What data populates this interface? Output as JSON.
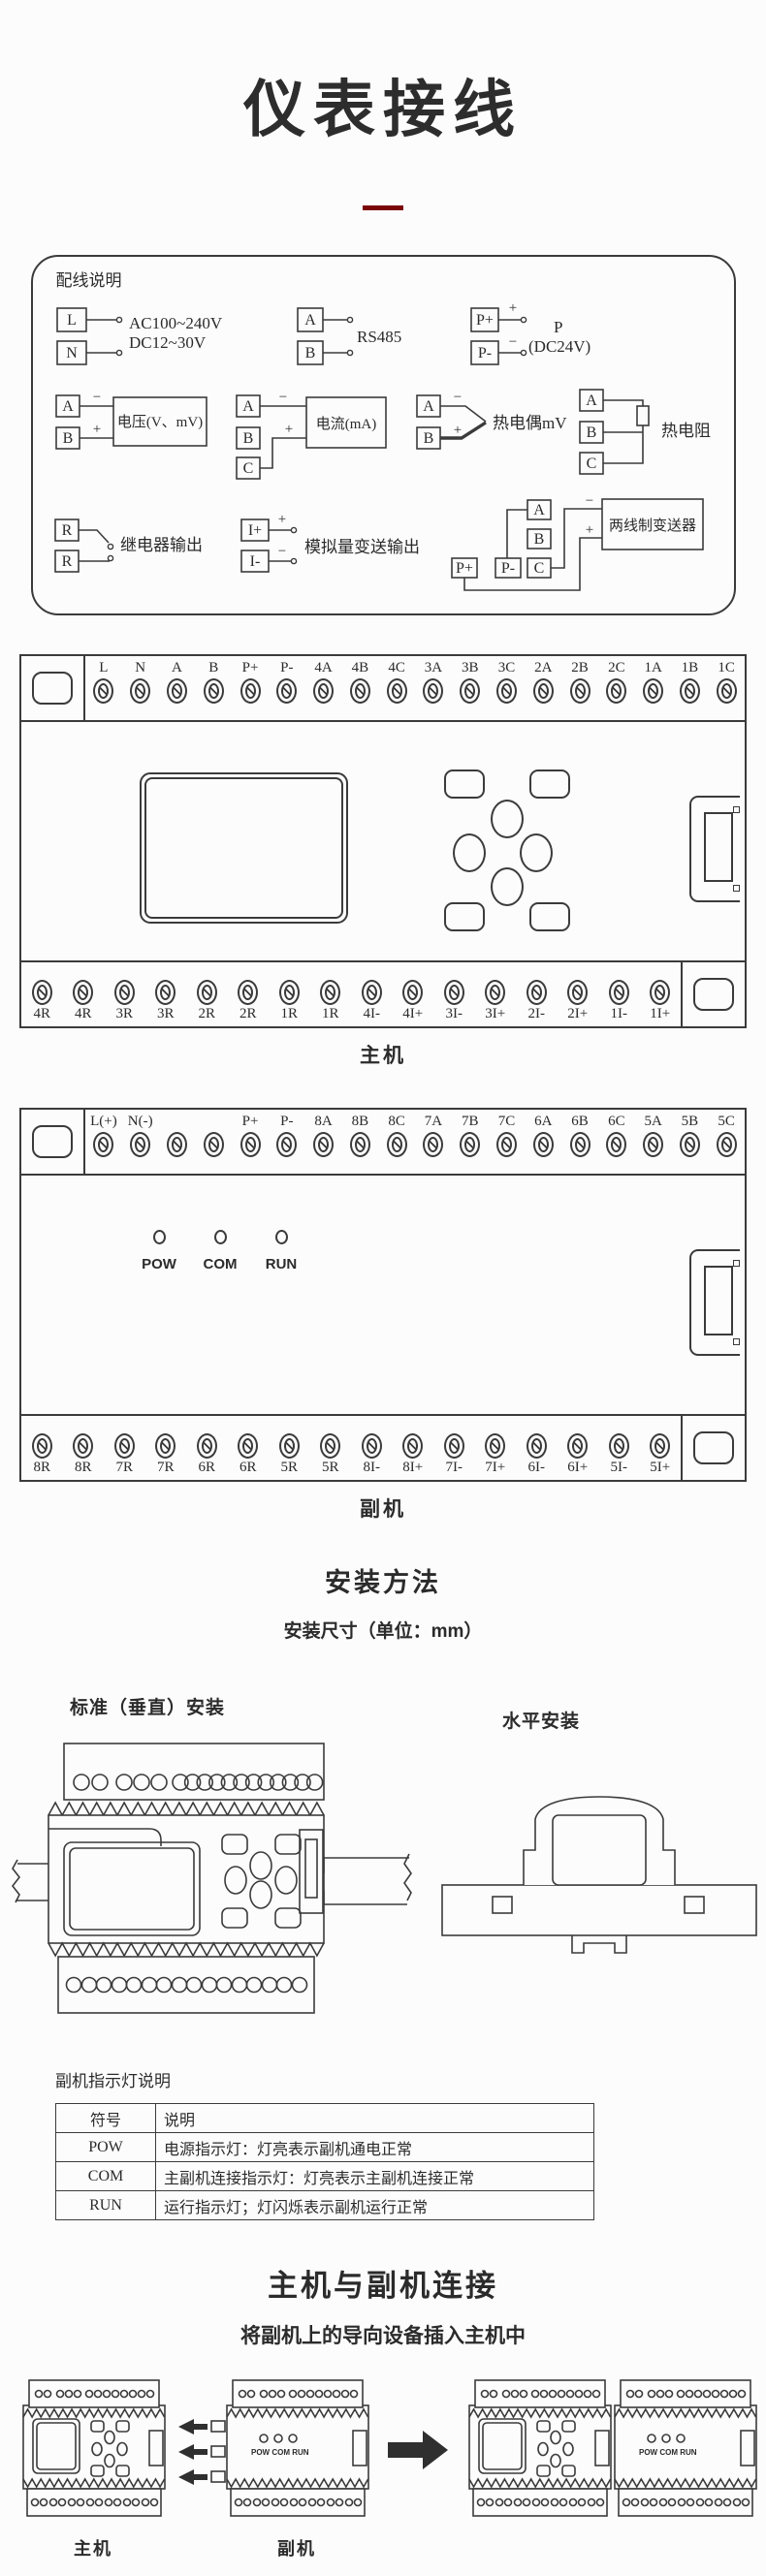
{
  "page": {
    "title": "仪表接线"
  },
  "wiring": {
    "box_title": "配线说明",
    "power": {
      "l": "L",
      "n": "N",
      "ac": "AC100~240V",
      "dc": "DC12~30V"
    },
    "rs485": {
      "a": "A",
      "b": "B",
      "label": "RS485"
    },
    "power24": {
      "pp": "P+",
      "pm": "P-",
      "plus": "+",
      "minus": "−",
      "p": "P",
      "dc": "(DC24V)"
    },
    "voltage": {
      "a": "A",
      "b": "B",
      "plus": "+",
      "minus": "−",
      "label": "电压(V、mV)"
    },
    "current": {
      "a": "A",
      "b": "B",
      "c": "C",
      "plus": "+",
      "minus": "−",
      "label": "电流(mA)"
    },
    "tc": {
      "a": "A",
      "b": "B",
      "plus": "+",
      "minus": "−",
      "label": "热电偶mV"
    },
    "rtd": {
      "a": "A",
      "b": "B",
      "c": "C",
      "label": "热电阻"
    },
    "relay": {
      "r1": "R",
      "r2": "R",
      "label": "继电器输出"
    },
    "analog": {
      "ip": "I+",
      "im": "I-",
      "plus": "+",
      "minus": "−",
      "label": "模拟量变送输出"
    },
    "transmitter": {
      "a": "A",
      "b": "B",
      "c": "C",
      "pp": "P+",
      "pm": "P-",
      "plus": "+",
      "minus": "−",
      "label": "两线制变送器"
    }
  },
  "host": {
    "caption": "主机",
    "top_terminals": [
      "L",
      "N",
      "A",
      "B",
      "P+",
      "P-",
      "4A",
      "4B",
      "4C",
      "3A",
      "3B",
      "3C",
      "2A",
      "2B",
      "2C",
      "1A",
      "1B",
      "1C"
    ],
    "bottom_terminals": [
      "4R",
      "4R",
      "3R",
      "3R",
      "2R",
      "2R",
      "1R",
      "1R",
      "4I-",
      "4I+",
      "3I-",
      "3I+",
      "2I-",
      "2I+",
      "1I-",
      "1I+"
    ]
  },
  "sub": {
    "caption": "副机",
    "top_terminals": [
      "L(+)",
      "N(-)",
      "",
      "",
      "P+",
      "P-",
      "8A",
      "8B",
      "8C",
      "7A",
      "7B",
      "7C",
      "6A",
      "6B",
      "6C",
      "5A",
      "5B",
      "5C"
    ],
    "bottom_terminals": [
      "8R",
      "8R",
      "7R",
      "7R",
      "6R",
      "6R",
      "5R",
      "5R",
      "8I-",
      "8I+",
      "7I-",
      "7I+",
      "6I-",
      "6I+",
      "5I-",
      "5I+"
    ],
    "leds": [
      "POW",
      "COM",
      "RUN"
    ]
  },
  "install": {
    "heading": "安装方法",
    "subheading": "安装尺寸（单位：mm）",
    "vertical_label": "标准（垂直）安装",
    "horizontal_label": "水平安装"
  },
  "led_table": {
    "title": "副机指示灯说明",
    "headers": [
      "符号",
      "说明"
    ],
    "rows": [
      {
        "symbol": "POW",
        "desc": "电源指示灯：灯亮表示副机通电正常"
      },
      {
        "symbol": "COM",
        "desc": "主副机连接指示灯：灯亮表示主副机连接正常"
      },
      {
        "symbol": "RUN",
        "desc": "运行指示灯；灯闪烁表示副机运行正常"
      }
    ]
  },
  "connection": {
    "heading": "主机与副机连接",
    "subheading": "将副机上的导向设备插入主机中",
    "host_label": "主机",
    "sub_label": "副机",
    "mini_leds": "POW COM RUN"
  }
}
